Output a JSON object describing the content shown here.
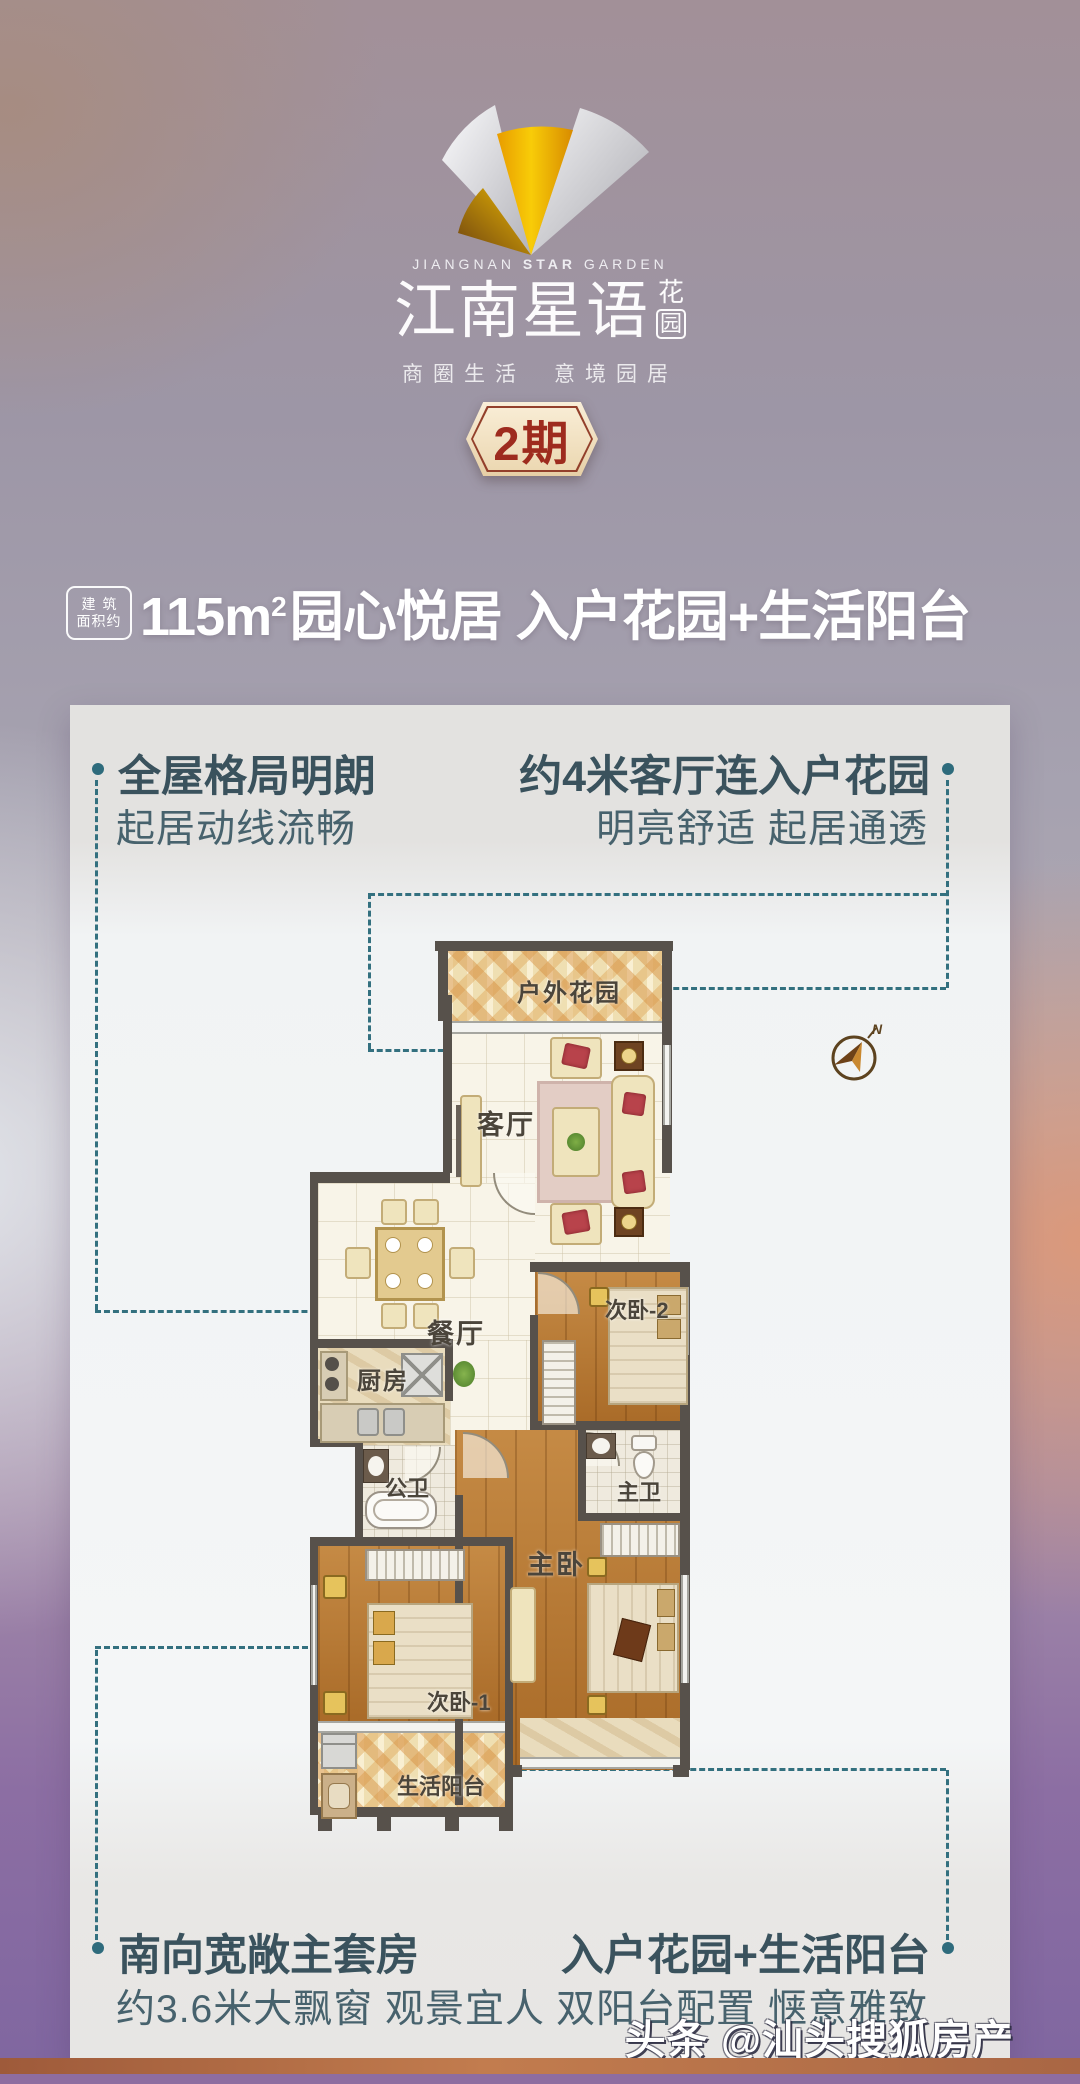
{
  "brand": {
    "en_parts": [
      "JIANGNAN",
      "STAR",
      "GARDEN"
    ],
    "cn_name": "江南星语",
    "suffix_top": "花",
    "suffix_bottom": "园",
    "tagline_left": "商圈生活",
    "tagline_right": "意境园居",
    "phase_badge": "2期"
  },
  "headline": {
    "area_badge_line1": "建筑",
    "area_badge_line2": "面积约",
    "area_value": "115m",
    "area_sup": "2",
    "title_rest": "园心悦居 入户花园+生活阳台"
  },
  "callouts": {
    "top_left": {
      "title": "全屋格局明朗",
      "subtitle": "起居动线流畅"
    },
    "top_right": {
      "title": "约4米客厅连入户花园",
      "subtitle": "明亮舒适 起居通透"
    },
    "bottom_left": {
      "title": "南向宽敞主套房",
      "subtitle": "约3.6米大飘窗 观景宜人"
    },
    "bottom_right": {
      "title": "入户花园+生活阳台",
      "subtitle": "双阳台配置 惬意雅致"
    }
  },
  "floorplan": {
    "rooms": [
      {
        "label": "户外花园"
      },
      {
        "label": "客厅"
      },
      {
        "label": "餐厅"
      },
      {
        "label": "次卧-2"
      },
      {
        "label": "厨房"
      },
      {
        "label": "公卫"
      },
      {
        "label": "主卫"
      },
      {
        "label": "主卧"
      },
      {
        "label": "次卧-1"
      },
      {
        "label": "生活阳台"
      }
    ],
    "compass_label": "N"
  },
  "watermark": "头条 @汕头搜狐房产",
  "colors": {
    "accent_teal": "#2e6b7c",
    "badge_red": "#9e2b1e",
    "gold": "#f2b705",
    "card_bg": "#eceeee",
    "wood": "#b5752e",
    "bottom_purple": "#8e6da0",
    "bottom_orange": "#b06a45"
  }
}
